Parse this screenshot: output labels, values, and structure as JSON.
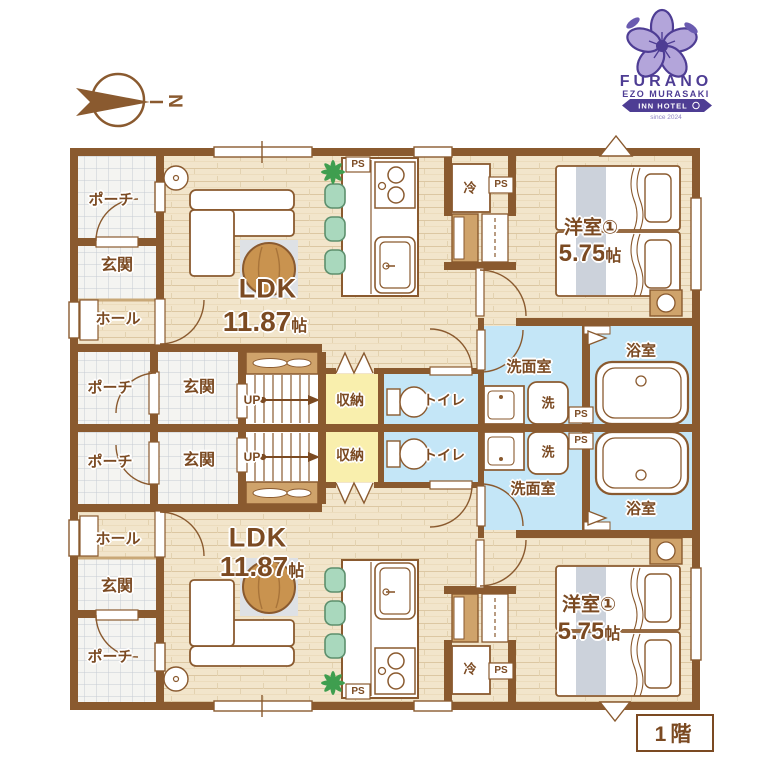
{
  "logo": {
    "brand": "FURANO",
    "subbrand": "EZO MURASAKI",
    "ribbon": "INN HOTEL",
    "tagline": "since 2024",
    "color": "#4e3d94"
  },
  "compass": {
    "north_label": "N"
  },
  "floor_badge": {
    "label": "1階"
  },
  "rooms": {
    "porch": "ポーチ",
    "entrance": "玄関",
    "hall": "ホール",
    "ldk": "LDK",
    "ldk_size": "11.87",
    "size_unit": "帖",
    "bedroom": "洋室①",
    "bedroom_size": "5.75",
    "washroom": "洗面室",
    "bathroom": "浴室",
    "laundry": "洗",
    "storage": "収納",
    "toilet": "トイレ",
    "fridge": "冷",
    "up": "UP",
    "ps": "PS"
  },
  "colors": {
    "wall": "#8a5a2f",
    "label_text": "#7b4a22",
    "wood_floor": "#f2e5cb",
    "tile_floor": "#f4f4f1",
    "wet_area": "#c4e6f7",
    "storage_area": "#f9efad",
    "rug": "#dee1e5",
    "stool_green": "#a9d8bd",
    "table_wood": "#c9934f",
    "logo_purple": "#4e3d94"
  }
}
